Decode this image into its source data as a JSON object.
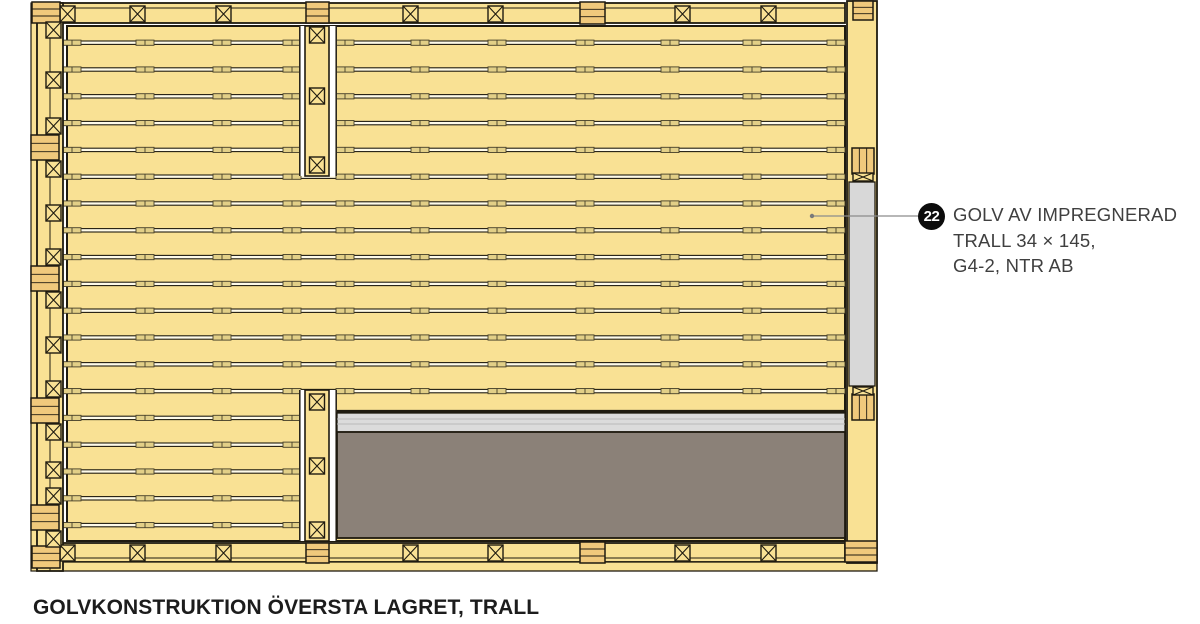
{
  "title": "GOLVKONSTRUKTION ÖVERSTA LAGRET, TRALL",
  "callout": {
    "number": "22",
    "line1": "GOLV AV IMPREGNERAD",
    "line2": "TRALL 34 × 145,",
    "line3": "G4-2, NTR AB"
  },
  "colors": {
    "wood": "#F9E194",
    "wood_dark": "#F0C97C",
    "gap_cream": "#FFFBE9",
    "outline": "#1f1b10",
    "mark_fill": "#E2CF87",
    "mark_stroke": "#453f29",
    "light_gray": "#DBDBDB",
    "strip_gray": "#D8D8D8",
    "dark_gray": "#8B8178",
    "leader": "#8c8c8c",
    "white": "#ffffff",
    "callout_bg": "#0c0c0c",
    "callout_text": "#ffffff",
    "text": "#3f3f3f"
  },
  "diagram": {
    "panel": {
      "x": 67,
      "y": 26,
      "w": 778,
      "right": 845,
      "bottom": 541,
      "gap_start": 41,
      "gap_pitch": 26.8,
      "gap_count": 19
    },
    "right_panel_gap_count": 14,
    "mark_cols_left": [
      72,
      145,
      222,
      292
    ],
    "mark_cols_right": [
      345,
      420,
      497,
      585,
      670,
      752,
      836
    ],
    "divider": {
      "x": 299,
      "w": 38,
      "beam_x": 305,
      "beam_w": 24,
      "top": {
        "y": 26,
        "h": 150,
        "x_ys": [
          24,
          88,
          157
        ]
      },
      "bottom": {
        "y": 390,
        "h": 151,
        "x_ys": [
          394,
          458,
          522
        ]
      }
    },
    "lower_section": {
      "x": 337,
      "w": 508,
      "edge_y": 410,
      "light_y": 413,
      "light_h": 19,
      "dark_y": 432,
      "dark_h": 106
    },
    "frame": {
      "top_beam": {
        "x": 60,
        "y": 3,
        "w": 785,
        "h": 20,
        "inner_line_y": 8
      },
      "bottom_beam": {
        "x": 60,
        "y": 543,
        "w": 785,
        "h": 19
      },
      "bottom_strip": {
        "x": 60,
        "y": 562,
        "w": 817,
        "h": 9
      },
      "left_outer": {
        "x": 31,
        "y": 3,
        "w": 6,
        "h": 568
      },
      "left_beam": {
        "x": 37,
        "y": 3,
        "w": 26,
        "h": 568,
        "split_x": 50
      },
      "left_lone_x_cy": [
        30,
        80,
        213,
        345,
        470
      ],
      "left_tab_tops": [
        135,
        266,
        398,
        505
      ],
      "right_beam": {
        "x": 847,
        "y": 1,
        "w": 30,
        "h": 562
      },
      "right_gray_strip": {
        "x": 849,
        "y": 182,
        "w": 26,
        "h": 204
      },
      "right_vtab_ys": [
        148,
        394
      ],
      "right_top_tab": {
        "x": 853,
        "y": 1,
        "w": 20,
        "h": 19
      },
      "right_bottom_tab": {
        "x": 845,
        "y": 541,
        "w": 32,
        "h": 21
      },
      "beam_x_positions": [
        60,
        130,
        216,
        403,
        488,
        675,
        761
      ],
      "tab_x": 580,
      "corner_left_top": {
        "x": 32,
        "y": 2,
        "w": 28,
        "h": 21
      },
      "corner_left_bottom": {
        "x": 32,
        "y": 546,
        "w": 28,
        "h": 22
      },
      "divider_cap_top": {
        "x": 306,
        "y": 2,
        "w": 23,
        "h": 21
      },
      "divider_cap_bottom": {
        "x": 306,
        "y": 543,
        "w": 23,
        "h": 20
      }
    },
    "leader": {
      "x1": 812,
      "y1": 216,
      "x2": 918,
      "y2": 216
    }
  }
}
